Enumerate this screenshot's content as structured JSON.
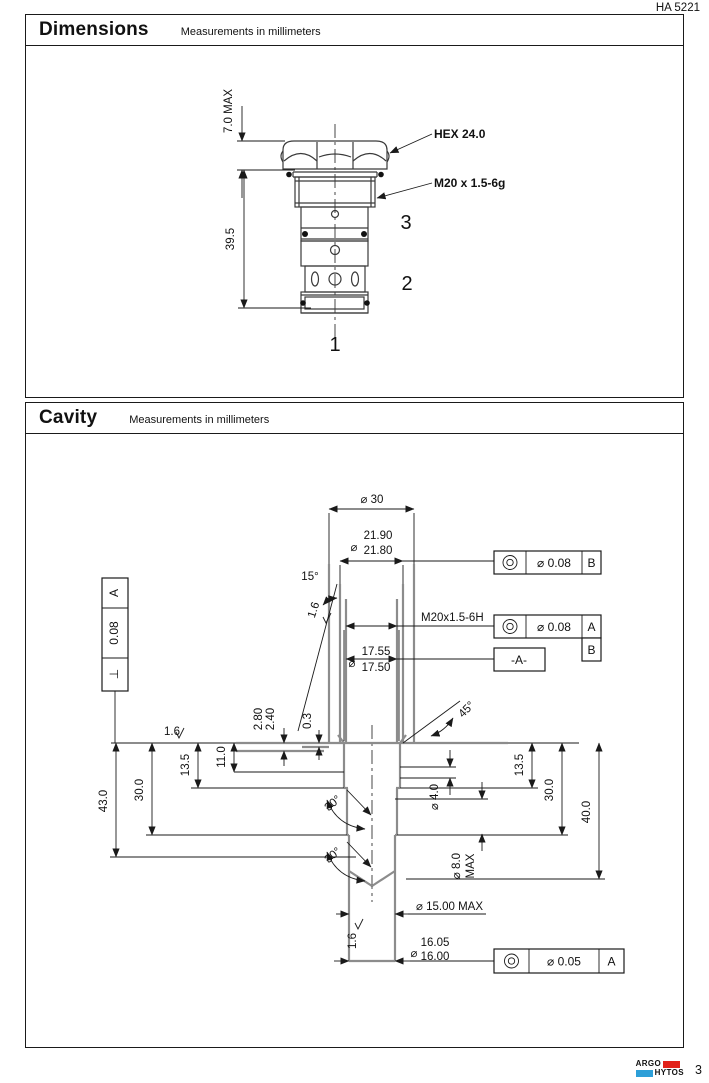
{
  "page": {
    "doc_code": "HA 5221",
    "page_number": "3"
  },
  "brand": {
    "name_top": "ARGO",
    "name_bottom": "HYTOS",
    "red": "#e2231a",
    "blue": "#2d9fd8"
  },
  "dimensions": {
    "title": "Dimensions",
    "subtitle": "Measurements in millimeters",
    "hex_label": "HEX 24.0",
    "thread_label": "M20 x  1.5-6g",
    "height_max": "7.0 MAX",
    "length": "39.5",
    "port1": "1",
    "port2": "2",
    "port3": "3"
  },
  "cavity": {
    "title": "Cavity",
    "subtitle": "Measurements in millimeters",
    "dia_symbol": "⌀",
    "dia30": "⌀ 30",
    "dia2190": "21.90",
    "dia2180": "21.80",
    "angle15": "15°",
    "roughness": "1.6",
    "thread_label": "M20x1.5-6H",
    "dia1755": "17.55",
    "dia1750": "17.50",
    "datum_a": "-A-",
    "fcf_top_tol": "⌀ 0.08",
    "fcf_top_datum": "B",
    "fcf_mid_tol": "⌀ 0.08",
    "fcf_mid_datum1": "A",
    "fcf_mid_datum2": "B",
    "fcf_left_tol": "0.08",
    "fcf_left_datum": "A",
    "perp_symbol": "⊥",
    "fcf_bot_tol": "⌀ 0.05",
    "fcf_bot_datum": "A",
    "dim280": "2.80",
    "dim240": "2.40",
    "dim03": "0.3",
    "angle45": "45°",
    "dim135_left": "13.5",
    "dim110": "11.0",
    "dim300_left": "30.0",
    "dim430": "43.0",
    "angle30_upper": "30°",
    "angle30_lower": "30°",
    "dia40": "⌀ 4.0",
    "dia80": "⌀ 8.0",
    "dia80_max": "MAX",
    "dim135_right": "13.5",
    "dim300_right": "30.0",
    "dim400": "40.0",
    "dia1500max": "⌀ 15.00 MAX",
    "dia1605": "16.05",
    "dia1600": "16.00"
  }
}
